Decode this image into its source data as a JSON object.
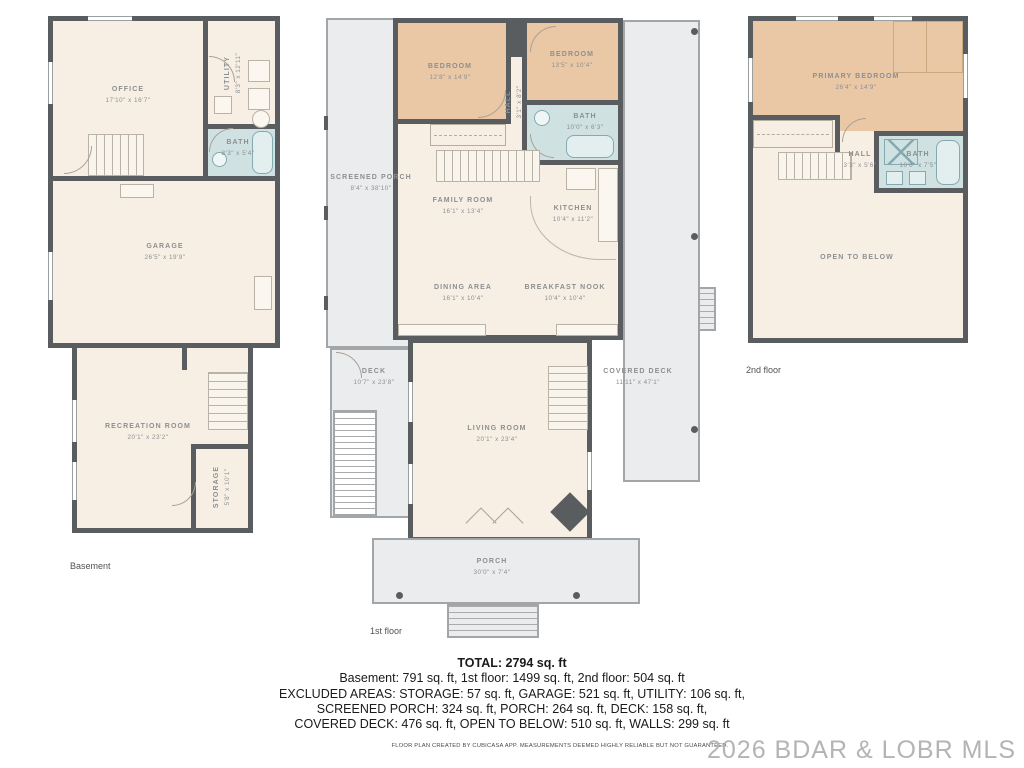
{
  "floors": {
    "basement": {
      "label": "Basement",
      "rooms": {
        "office": {
          "name": "OFFICE",
          "dims": "17'10\" x 16'7\""
        },
        "utility": {
          "name": "UTILITY",
          "dims": "8'3\" x 12'11\""
        },
        "bath": {
          "name": "BATH",
          "dims": "8'3\" x 5'4\""
        },
        "garage": {
          "name": "GARAGE",
          "dims": "26'5\" x 19'9\""
        },
        "recreation": {
          "name": "RECREATION ROOM",
          "dims": "20'1\" x 23'2\""
        },
        "storage": {
          "name": "STORAGE",
          "dims": "5'8\" x 10'1\""
        }
      }
    },
    "first": {
      "label": "1st floor",
      "rooms": {
        "bedroom1": {
          "name": "BEDROOM",
          "dims": "12'8\" x 14'9\""
        },
        "bedroom2": {
          "name": "BEDROOM",
          "dims": "13'5\" x 10'4\""
        },
        "hall": {
          "name": "HALL",
          "dims": "3'1\" x 8'2\""
        },
        "bath": {
          "name": "BATH",
          "dims": "10'0\" x 6'3\""
        },
        "screened_porch": {
          "name": "SCREENED PORCH",
          "dims": "8'4\" x 38'10\""
        },
        "family": {
          "name": "FAMILY ROOM",
          "dims": "16'1\" x 13'4\""
        },
        "kitchen": {
          "name": "KITCHEN",
          "dims": "10'4\" x 11'2\""
        },
        "dining": {
          "name": "DINING AREA",
          "dims": "16'1\" x 10'4\""
        },
        "breakfast": {
          "name": "BREAKFAST NOOK",
          "dims": "10'4\" x 10'4\""
        },
        "deck": {
          "name": "DECK",
          "dims": "10'7\" x 23'8\""
        },
        "covered_deck": {
          "name": "COVERED DECK",
          "dims": "11'11\" x 47'1\""
        },
        "living": {
          "name": "LIVING ROOM",
          "dims": "20'1\" x 23'4\""
        },
        "porch": {
          "name": "PORCH",
          "dims": "30'0\" x 7'4\""
        }
      }
    },
    "second": {
      "label": "2nd floor",
      "rooms": {
        "primary": {
          "name": "PRIMARY BEDROOM",
          "dims": "26'4\" x 14'9\""
        },
        "hall": {
          "name": "HALL",
          "dims": "3'3\" x 5'6\""
        },
        "bath": {
          "name": "BATH",
          "dims": "10'6\" x 7'5\""
        },
        "open": {
          "name": "OPEN TO BELOW"
        }
      }
    }
  },
  "summary": {
    "total": "TOTAL: 2794 sq. ft",
    "line2": "Basement: 791 sq. ft, 1st floor: 1499 sq. ft, 2nd floor: 504 sq. ft",
    "line3": "EXCLUDED AREAS: STORAGE: 57 sq. ft, GARAGE: 521 sq. ft, UTILITY: 106 sq. ft,",
    "line4": "SCREENED PORCH: 324 sq. ft, PORCH: 264 sq. ft, DECK: 158 sq. ft,",
    "line5": "COVERED DECK: 476 sq. ft, OPEN TO BELOW: 510 sq. ft, WALLS: 299 sq. ft"
  },
  "footer": {
    "disclaimer": "FLOOR PLAN CREATED BY CUBICASA APP. MEASUREMENTS DEEMED HIGHLY RELIABLE BUT NOT GUARANTEED.",
    "watermark": "2026 BDAR & LOBR MLS"
  },
  "colors": {
    "wall": "#5a5d5f",
    "room": "#f7efe4",
    "bedroom": "#eac7a5",
    "bath": "#cfe1e1",
    "deck": "#ebeced",
    "label_text": "#8c8f91",
    "watermark": "#b2b4b6"
  }
}
